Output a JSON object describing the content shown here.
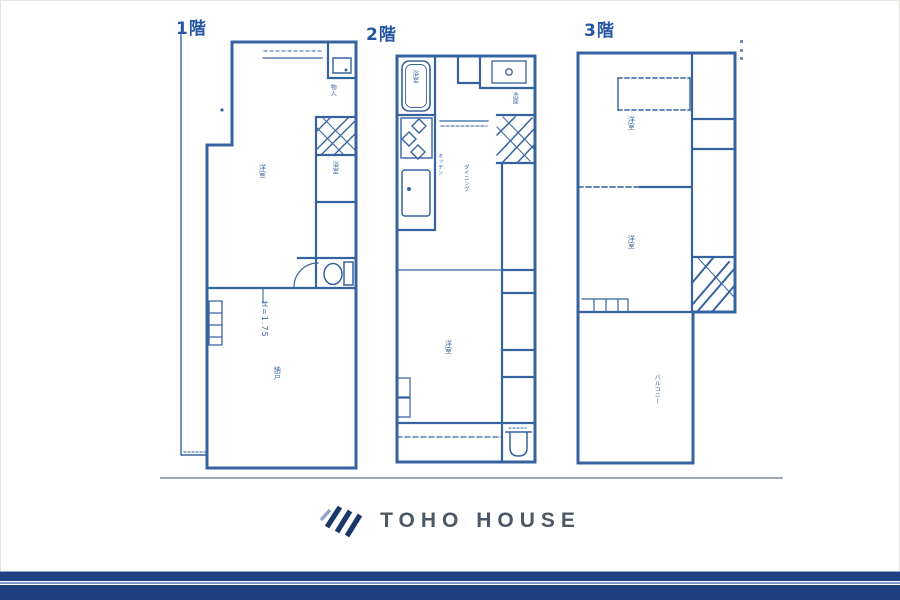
{
  "colors": {
    "plan_line": "#35639f",
    "plan_text": "#2f5d9c",
    "floor_label": "#2456a3",
    "ground": "#8f98a2",
    "navy_bar": "#1d3f80",
    "navy_stripe": "#1e4184",
    "stripe_light": "#7b9cd0",
    "stripe_edge": "#8ea8d0",
    "logo_navy": "#1c3869",
    "logo_accent": "#8fa5c8",
    "logo_text_color": "#4d5866"
  },
  "floors": {
    "f1": {
      "label": "1階",
      "room_main": "洋室",
      "closet_upper": "物入",
      "bath": "浴室",
      "storage": "納戸",
      "height_note": "H=1.75"
    },
    "f2": {
      "label": "2階",
      "bath": "浴室",
      "washroom": "洗面",
      "kitchen": "キッチン",
      "dining": "ダイニング",
      "room_main": "洋室"
    },
    "f3": {
      "label": "3階",
      "room_upper": "洋室",
      "room_mid": "洋室",
      "balcony": "バルコニー"
    }
  },
  "footer": {
    "logo_text": "TOHO HOUSE"
  }
}
